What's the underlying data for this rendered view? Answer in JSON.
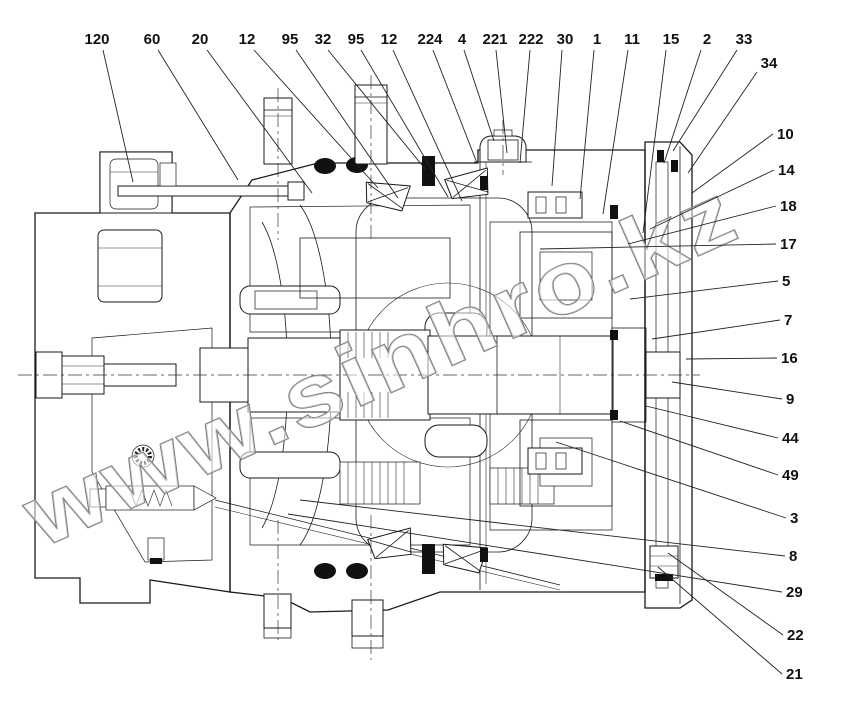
{
  "figure": {
    "type": "technical-cross-section-diagram",
    "subject": "hydraulic motor gearbox sectional drawing with part callouts",
    "background_color": "#ffffff",
    "line_color": "#1a1a1a"
  },
  "watermark": {
    "text": "www.sinhro.kz",
    "color": "#777777",
    "font_size": 88,
    "rotation_deg": -24
  },
  "callouts": {
    "font_size": 15,
    "items": [
      {
        "text": "120",
        "x": 97,
        "y": 44,
        "anchor": "middle",
        "x1": 103,
        "y1": 50,
        "x2": 133,
        "y2": 182
      },
      {
        "text": "60",
        "x": 152,
        "y": 44,
        "anchor": "middle",
        "x1": 158,
        "y1": 50,
        "x2": 238,
        "y2": 180
      },
      {
        "text": "20",
        "x": 200,
        "y": 44,
        "anchor": "middle",
        "x1": 207,
        "y1": 50,
        "x2": 312,
        "y2": 193
      },
      {
        "text": "12",
        "x": 247,
        "y": 44,
        "anchor": "middle",
        "x1": 254,
        "y1": 50,
        "x2": 378,
        "y2": 188
      },
      {
        "text": "95",
        "x": 290,
        "y": 44,
        "anchor": "middle",
        "x1": 296,
        "y1": 50,
        "x2": 398,
        "y2": 198
      },
      {
        "text": "32",
        "x": 323,
        "y": 44,
        "anchor": "middle",
        "x1": 328,
        "y1": 50,
        "x2": 426,
        "y2": 170
      },
      {
        "text": "95",
        "x": 356,
        "y": 44,
        "anchor": "middle",
        "x1": 361,
        "y1": 50,
        "x2": 448,
        "y2": 197
      },
      {
        "text": "12",
        "x": 389,
        "y": 44,
        "anchor": "middle",
        "x1": 393,
        "y1": 50,
        "x2": 462,
        "y2": 201
      },
      {
        "text": "224",
        "x": 430,
        "y": 44,
        "anchor": "middle",
        "x1": 433,
        "y1": 50,
        "x2": 477,
        "y2": 163
      },
      {
        "text": "4",
        "x": 462,
        "y": 44,
        "anchor": "middle",
        "x1": 464,
        "y1": 50,
        "x2": 494,
        "y2": 141
      },
      {
        "text": "221",
        "x": 495,
        "y": 44,
        "anchor": "middle",
        "x1": 496,
        "y1": 50,
        "x2": 507,
        "y2": 153
      },
      {
        "text": "222",
        "x": 531,
        "y": 44,
        "anchor": "middle",
        "x1": 530,
        "y1": 50,
        "x2": 520,
        "y2": 163
      },
      {
        "text": "30",
        "x": 565,
        "y": 44,
        "anchor": "middle",
        "x1": 562,
        "y1": 50,
        "x2": 552,
        "y2": 186
      },
      {
        "text": "1",
        "x": 597,
        "y": 44,
        "anchor": "middle",
        "x1": 594,
        "y1": 50,
        "x2": 580,
        "y2": 199
      },
      {
        "text": "11",
        "x": 632,
        "y": 44,
        "anchor": "middle",
        "x1": 628,
        "y1": 50,
        "x2": 603,
        "y2": 214
      },
      {
        "text": "15",
        "x": 671,
        "y": 44,
        "anchor": "middle",
        "x1": 666,
        "y1": 50,
        "x2": 643,
        "y2": 233
      },
      {
        "text": "2",
        "x": 707,
        "y": 44,
        "anchor": "middle",
        "x1": 701,
        "y1": 50,
        "x2": 664,
        "y2": 163
      },
      {
        "text": "33",
        "x": 744,
        "y": 44,
        "anchor": "middle",
        "x1": 737,
        "y1": 50,
        "x2": 673,
        "y2": 151
      },
      {
        "text": "34",
        "x": 769,
        "y": 68,
        "anchor": "middle",
        "x1": 757,
        "y1": 72,
        "x2": 688,
        "y2": 173
      },
      {
        "text": "10",
        "x": 777,
        "y": 139,
        "anchor": "start",
        "x1": 773,
        "y1": 134,
        "x2": 692,
        "y2": 193
      },
      {
        "text": "14",
        "x": 778,
        "y": 175,
        "anchor": "start",
        "x1": 774,
        "y1": 170,
        "x2": 650,
        "y2": 229
      },
      {
        "text": "18",
        "x": 780,
        "y": 211,
        "anchor": "start",
        "x1": 776,
        "y1": 206,
        "x2": 628,
        "y2": 244
      },
      {
        "text": "17",
        "x": 780,
        "y": 249,
        "anchor": "start",
        "x1": 776,
        "y1": 244,
        "x2": 540,
        "y2": 249
      },
      {
        "text": "5",
        "x": 782,
        "y": 286,
        "anchor": "start",
        "x1": 778,
        "y1": 281,
        "x2": 630,
        "y2": 299
      },
      {
        "text": "7",
        "x": 784,
        "y": 325,
        "anchor": "start",
        "x1": 780,
        "y1": 320,
        "x2": 652,
        "y2": 339
      },
      {
        "text": "16",
        "x": 781,
        "y": 363,
        "anchor": "start",
        "x1": 777,
        "y1": 358,
        "x2": 686,
        "y2": 359
      },
      {
        "text": "9",
        "x": 786,
        "y": 404,
        "anchor": "start",
        "x1": 782,
        "y1": 399,
        "x2": 672,
        "y2": 382
      },
      {
        "text": "44",
        "x": 782,
        "y": 443,
        "anchor": "start",
        "x1": 778,
        "y1": 438,
        "x2": 646,
        "y2": 406
      },
      {
        "text": "49",
        "x": 782,
        "y": 480,
        "anchor": "start",
        "x1": 778,
        "y1": 475,
        "x2": 620,
        "y2": 421
      },
      {
        "text": "3",
        "x": 790,
        "y": 523,
        "anchor": "start",
        "x1": 786,
        "y1": 518,
        "x2": 556,
        "y2": 442
      },
      {
        "text": "8",
        "x": 789,
        "y": 561,
        "anchor": "start",
        "x1": 785,
        "y1": 556,
        "x2": 300,
        "y2": 500
      },
      {
        "text": "29",
        "x": 786,
        "y": 597,
        "anchor": "start",
        "x1": 782,
        "y1": 592,
        "x2": 288,
        "y2": 514
      },
      {
        "text": "22",
        "x": 787,
        "y": 640,
        "anchor": "start",
        "x1": 783,
        "y1": 635,
        "x2": 668,
        "y2": 553
      },
      {
        "text": "21",
        "x": 786,
        "y": 679,
        "anchor": "start",
        "x1": 782,
        "y1": 674,
        "x2": 658,
        "y2": 567
      }
    ]
  }
}
